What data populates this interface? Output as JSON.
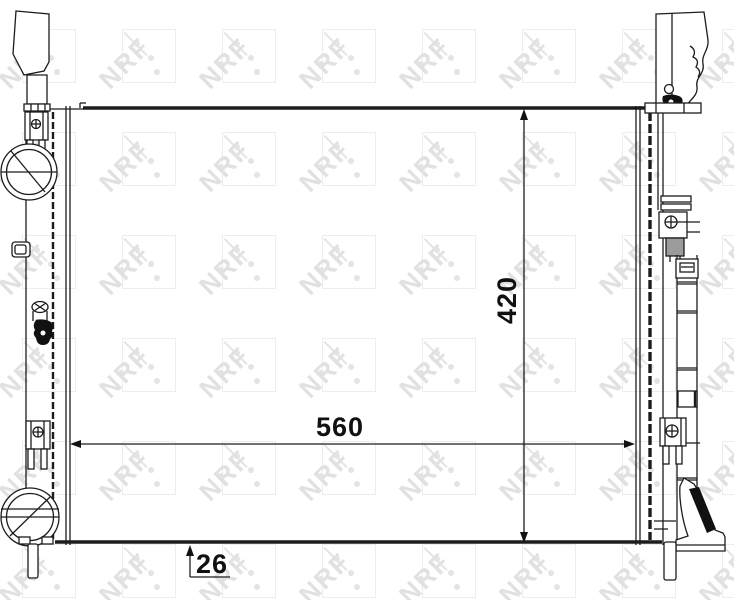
{
  "page": {
    "background": "#ffffff"
  },
  "watermark": {
    "text": "NRF",
    "square_color": "#ededed",
    "logo_color": "#e1e1e1",
    "dot_color": "#e4e4e4",
    "grid": {
      "start_x": 22,
      "start_y": 29,
      "step_x": 100,
      "step_y": 103,
      "cols": 8,
      "rows": 6
    }
  },
  "drawing": {
    "stroke_color": "#1c1c1c",
    "mount_color": "#9b9b9b"
  },
  "dimensions": {
    "width": {
      "label": "560"
    },
    "height": {
      "label": "420"
    },
    "depth": {
      "label": "26"
    }
  }
}
